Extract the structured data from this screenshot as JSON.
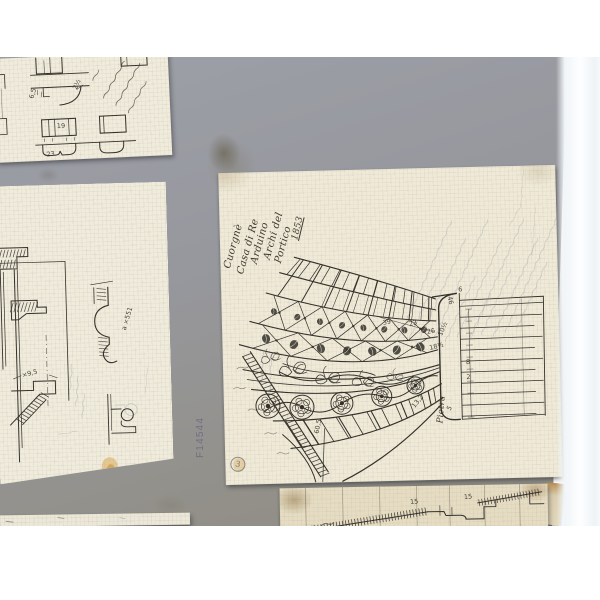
{
  "scene": {
    "description": "Archival photograph of hand-drawn architectural sketches on squared paper, mounted on a grey card",
    "board_color": "#95969c",
    "paper_color": "#efead9",
    "ink_color": "#34312b",
    "pencil_color": "#818998"
  },
  "board": {
    "archive_label": "F14544",
    "stamp_number": "3"
  },
  "central_sheet": {
    "title_lines": [
      "Cuorgnè",
      "Casa di Re",
      "Arduino",
      "Archi del",
      "Portico",
      "1853"
    ],
    "pier_label": "Pietra",
    "dims": [
      "23",
      "39",
      "26",
      "18½",
      "10½",
      "46",
      "6",
      "5",
      "2",
      "8",
      "60,5",
      "13,2"
    ]
  },
  "left_sheet": {
    "dims": [
      "a ×551",
      "×9,5"
    ]
  },
  "topleft_sheet": {
    "dims": [
      "19",
      "23",
      "6,5",
      "2½"
    ]
  },
  "bottomright_sheet": {
    "dims": [
      "15",
      "15"
    ]
  }
}
